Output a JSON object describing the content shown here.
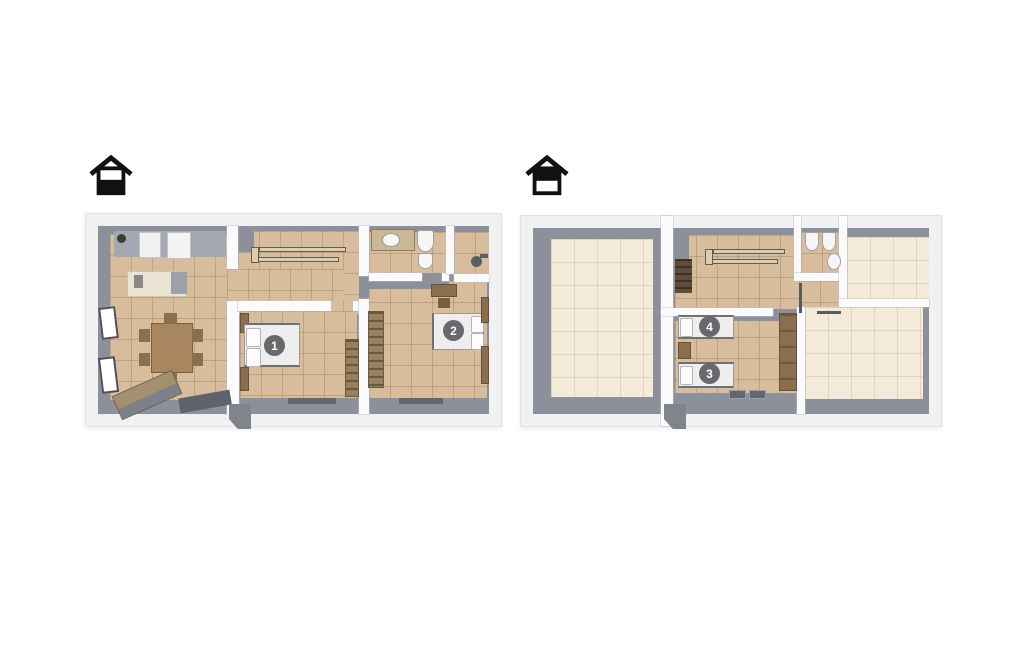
{
  "page": {
    "background_color": "#ffffff",
    "content": "3D top-down floor plan, two levels side by side"
  },
  "palette": {
    "outer_wall": "#f1f1f4",
    "interior_wall_face": "#8b909a",
    "floor_tile": "#d7bd9c",
    "floor_pale": "#f4ead9",
    "partition_wall": "#fbfbfd",
    "wood": "#8a6f4e",
    "badge_background": "#69696d",
    "badge_text": "#ffffff",
    "icon_color": "#111111"
  },
  "floors": [
    {
      "name": "ground-floor",
      "level_icon": "house-ground-floor-icon",
      "room_badges": [
        {
          "number": "1"
        },
        {
          "number": "2"
        }
      ]
    },
    {
      "name": "upper-floor",
      "level_icon": "house-upper-floor-icon",
      "room_badges": [
        {
          "number": "3"
        },
        {
          "number": "4"
        }
      ]
    }
  ]
}
